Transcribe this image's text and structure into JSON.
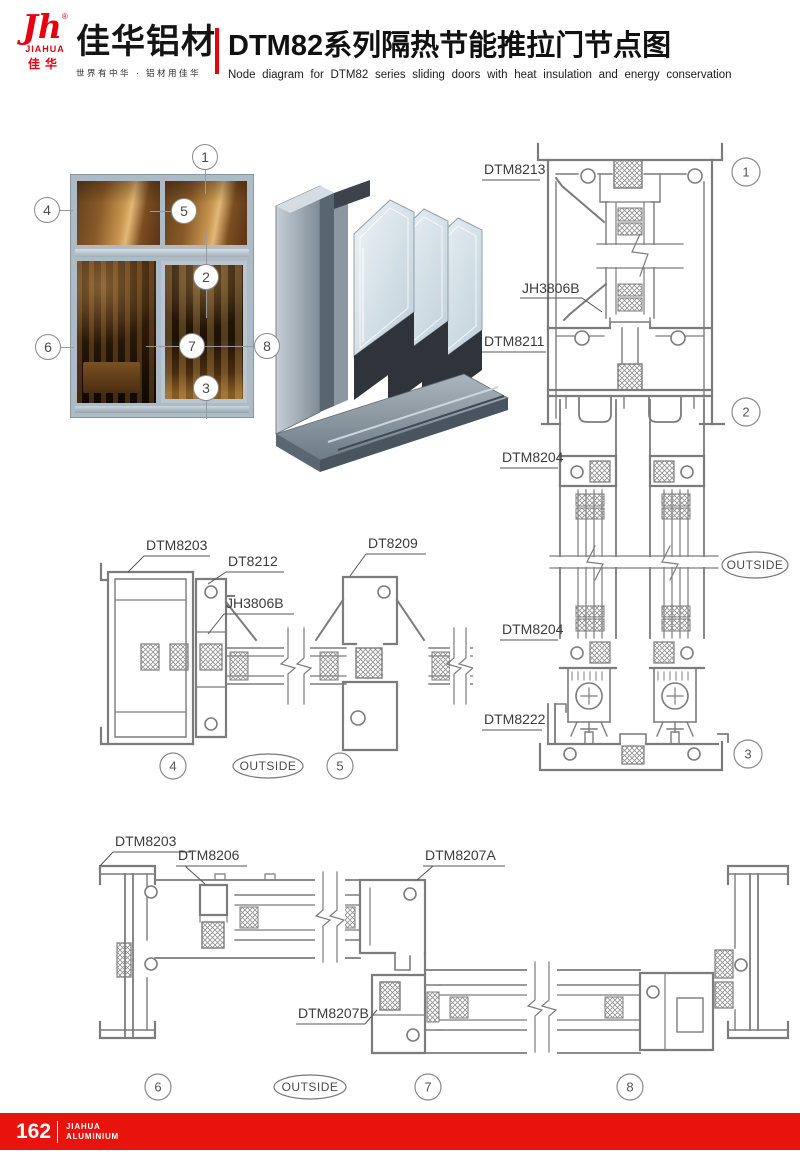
{
  "header": {
    "logo_monogram": "Jh",
    "logo_registered": "®",
    "logo_en": "JIAHUA",
    "logo_cn": "佳华",
    "brand": "佳华铝材",
    "tagline": "世界有中华 · 铝材用佳华",
    "title": "DTM82系列隔热节能推拉门节点图",
    "subtitle": "Node diagram for DTM82 series sliding doors with heat insulation and energy conservation"
  },
  "photo": {
    "callouts": {
      "c1": "1",
      "c2": "2",
      "c3": "3",
      "c4": "4",
      "c5": "5",
      "c6": "6",
      "c7": "7",
      "c8": "8"
    }
  },
  "vertical_section": {
    "label_head_frame": "DTM8213",
    "label_glazing_clamp": "JH3806B",
    "label_transom": "DTM8211",
    "label_sash_rail_upper": "DTM8204",
    "label_sash_rail_lower": "DTM8204",
    "label_bottom_track": "DTM8222",
    "outside_tag": "OUTSIDE",
    "callout_head": "1",
    "callout_transom": "2",
    "callout_sill": "3"
  },
  "mid_section": {
    "label_frame": "DTM8203",
    "label_interlock": "DT8212",
    "label_glazing_clamp": "JH3806B",
    "label_meeting_stile": "DT8209",
    "outside_tag": "OUTSIDE",
    "callout_jamb": "4",
    "callout_meeting": "5"
  },
  "bottom_section": {
    "label_frame": "DTM8203",
    "label_corner_block": "DTM8206",
    "label_interlock_a": "DTM8207A",
    "label_interlock_b": "DTM8207B",
    "outside_tag": "OUTSIDE",
    "callout_left_jamb": "6",
    "callout_meeting": "7",
    "callout_right_jamb": "8"
  },
  "footer": {
    "page_number": "162",
    "brand_line1": "JIAHUA",
    "brand_line2": "ALUMINIUM"
  },
  "colors": {
    "accent_red": "#e8130c",
    "logo_red": "#e60012",
    "drawing_gray": "#7c7c7c"
  }
}
